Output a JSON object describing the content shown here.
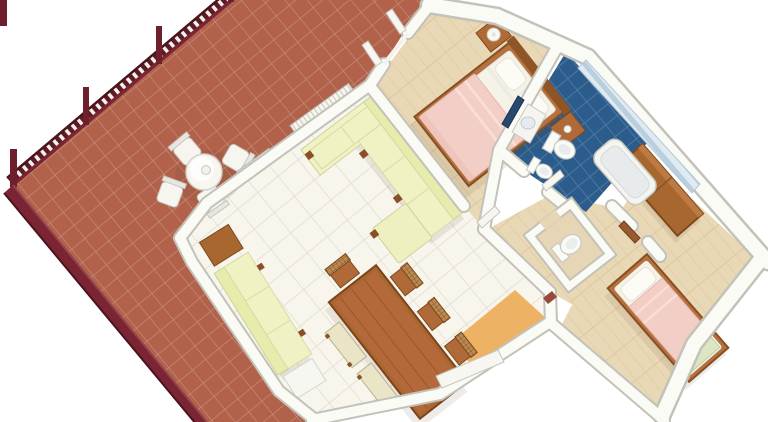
{
  "scene": {
    "type": "3d-floor-plan-render",
    "description": "Isometric 3D rendering of an apartment floor plan viewed from above at an angle: large tiled terrace with railing on the left, living/dining room in the center, double bedroom at top, blue-tiled bathroom and WC on the right, and a second bedroom at bottom right. No text labels are visible.",
    "background": "#ffffff",
    "no_visible_text": true
  },
  "palette": {
    "terrace_tile": "#b2614b",
    "terrace_grout": "#c6917d",
    "railing_dark": "#5d1b26",
    "railing_main": "#6d1f2b",
    "curb": "#7b2433",
    "curb_light": "#95434f",
    "baluster_white": "#f3f1ea",
    "wall_top": "#fbfbf6",
    "wall_edge": "#c3c2b9",
    "interior_tile": "#f8f5ec",
    "interior_grout": "#e1ddd0",
    "wood_floor": "#e9d8b5",
    "wood_floor_line": "#dcc69c",
    "entry_floor": "#eeb264",
    "bathroom_floor": "#2b5c8c",
    "bathroom_grout": "#527fa6",
    "stripe_wall_a": "#dfeaf1",
    "stripe_wall_b": "#b9cfdd",
    "wood_furniture": "#a96730",
    "wood_dark": "#7d4a1f",
    "bed_frame": "#b5713f",
    "mattress": "#f5f2e8",
    "pillow": "#fcfbf6",
    "blanket_pink": "#f3cec6",
    "sofa_cream": "#f0f2c4",
    "sofa_back": "#e7ecad",
    "mirror_blue": "#27496d",
    "fixture_white": "#fafaf8",
    "green_pad": "#dce6c4"
  },
  "rooms": [
    {
      "id": "terrace",
      "label": "terrace",
      "floor": "red clay tiles",
      "items": [
        "railing",
        "round table",
        "chairs",
        "radiators",
        "open doors"
      ]
    },
    {
      "id": "living-room",
      "label": "living-dining room",
      "floor": "cream tiles",
      "items": [
        "l-shaped sofa",
        "daybed",
        "dining table",
        "chairs",
        "benches",
        "side tables"
      ]
    },
    {
      "id": "bedroom-1",
      "label": "double bedroom",
      "floor": "light wood",
      "items": [
        "double bed",
        "nightstands",
        "lamp"
      ]
    },
    {
      "id": "bathroom",
      "label": "bathroom",
      "floor": "blue tiles",
      "items": [
        "bathtub",
        "toilet",
        "bidet",
        "sink",
        "mirror"
      ]
    },
    {
      "id": "wc",
      "label": "wc",
      "floor": "light wood",
      "items": [
        "toilet"
      ]
    },
    {
      "id": "hall",
      "label": "hallway",
      "floor": "light wood",
      "items": []
    },
    {
      "id": "entry",
      "label": "entry",
      "floor": "orange wood",
      "items": [
        "entrance door"
      ]
    },
    {
      "id": "bedroom-2",
      "label": "single bedroom",
      "floor": "light wood",
      "items": [
        "single bed",
        "wardrobe"
      ]
    }
  ],
  "counts": {
    "railing_posts": 4,
    "terrace_chairs": 4,
    "dining_chairs": 4,
    "dining_benches": 2,
    "radiators": 2
  }
}
